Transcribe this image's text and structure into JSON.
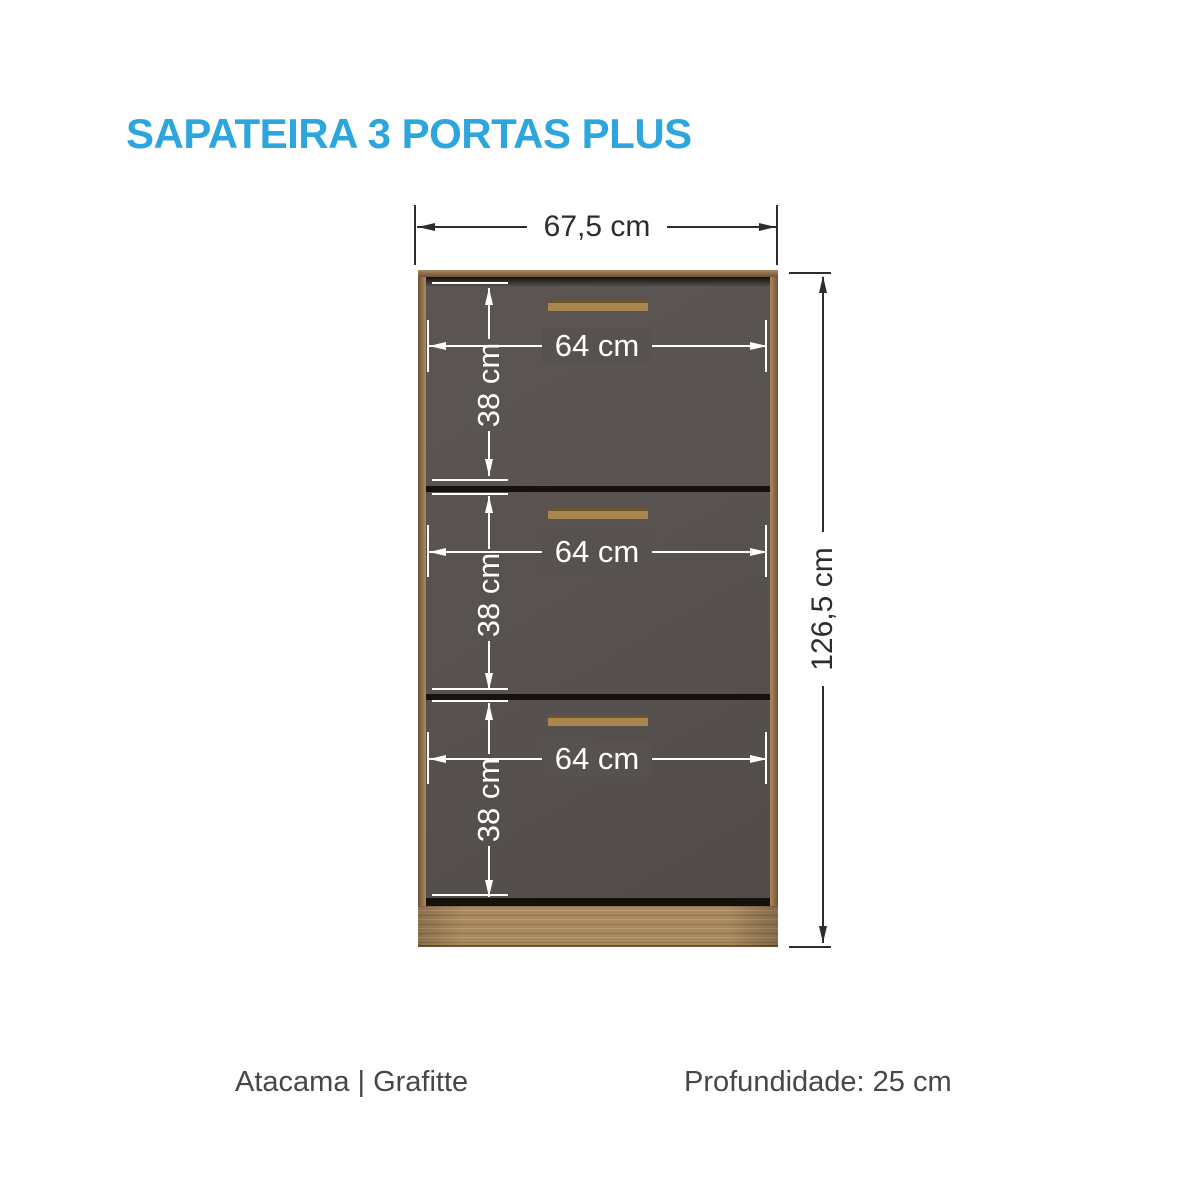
{
  "title": "SAPATEIRA 3 PORTAS PLUS",
  "overall": {
    "width_label": "67,5 cm",
    "height_label": "126,5 cm"
  },
  "doors": [
    {
      "width_label": "64 cm",
      "height_label": "38 cm"
    },
    {
      "width_label": "64 cm",
      "height_label": "38 cm"
    },
    {
      "width_label": "64 cm",
      "height_label": "38 cm"
    }
  ],
  "footer": {
    "finish": "Atacama | Grafitte",
    "depth": "Profundidade: 25 cm"
  },
  "colors": {
    "accent": "#2CA6DD",
    "door": "#575150",
    "wood": "#97764E",
    "wood_dark": "#6C5336",
    "wood_light": "#A9895F",
    "handle": "#A7874E",
    "gap": "#17110E",
    "dim_dark": "#2D2D2D",
    "text_gray": "#474747"
  }
}
